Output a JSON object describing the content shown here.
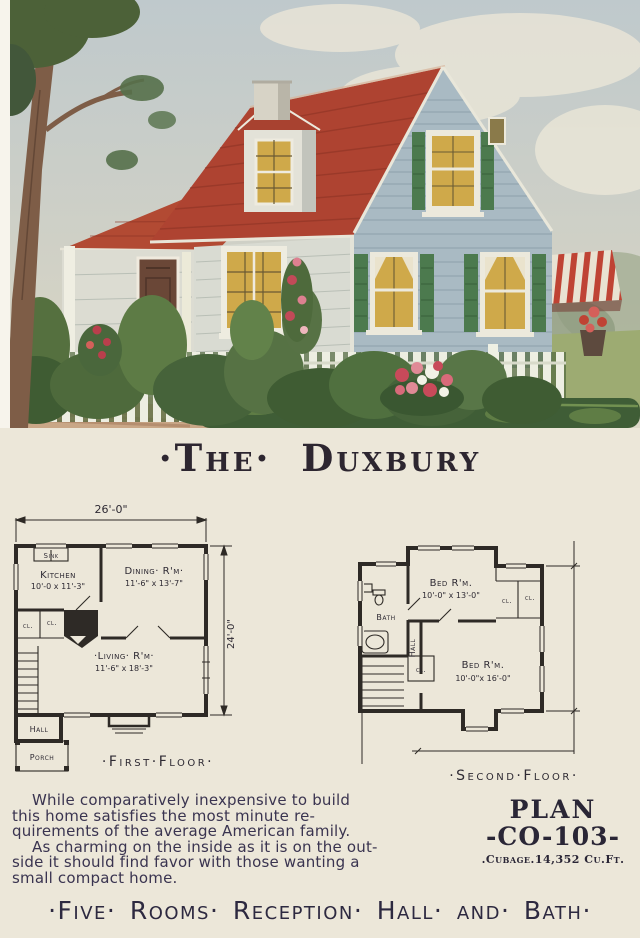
{
  "palette": {
    "paper": "#ece7d9",
    "ink": "#2e2a33",
    "roof_red": "#ae4331",
    "siding_blue_gray": "#a9bac3",
    "front_wall": "#d9dbd2",
    "shutter_green": "#4c7a4e",
    "window_glow": "#cfa94a",
    "foliage_green": "#4e6a3c",
    "fence_white": "#edeee2",
    "road_tan": "#c9a787"
  },
  "page": {
    "title": "·The· Duxbury",
    "footer": "·Five· Rooms· Reception· Hall· and· Bath·"
  },
  "first_floor": {
    "label": "·First·Floor·",
    "dim_width": "26'-0\"",
    "dim_height": "24'-0\"",
    "sink": "Sink",
    "kitchen_name": "Kitchen",
    "kitchen_dim": "10'-0 x 11'-3\"",
    "dining_name": "Dining· R'm·",
    "dining_dim": "11'-6\" x 13'-7\"",
    "living_name": "·Living· R'm·",
    "living_dim": "11'-6\" x 18'-3\"",
    "closet1": "cl.",
    "closet2": "cl.",
    "hall": "Hall",
    "porch": "Porch"
  },
  "second_floor": {
    "label": "·Second·Floor·",
    "bed1_name": "Bed R'm.",
    "bed1_dim": "10'-0\" x 13'-0\"",
    "bed2_name": "Bed R'm.",
    "bed2_dim": "10'-0\"x 16'-0\"",
    "bath": "Bath",
    "hall": "Hall",
    "closet1": "cl.",
    "closet2": "cl.",
    "closet3": "cl."
  },
  "description": {
    "lines": [
      "While comparatively inexpensive to build",
      "this home satisfies the most minute re-",
      "quirements of the average American family.",
      "As charming on the inside as it is on the out-",
      "side it should find favor with those wanting a",
      "small compact home."
    ]
  },
  "plan_info": {
    "heading": "PLAN",
    "number": "-CO-103-",
    "cubage": ".Cubage.14,352 Cu.Ft."
  }
}
